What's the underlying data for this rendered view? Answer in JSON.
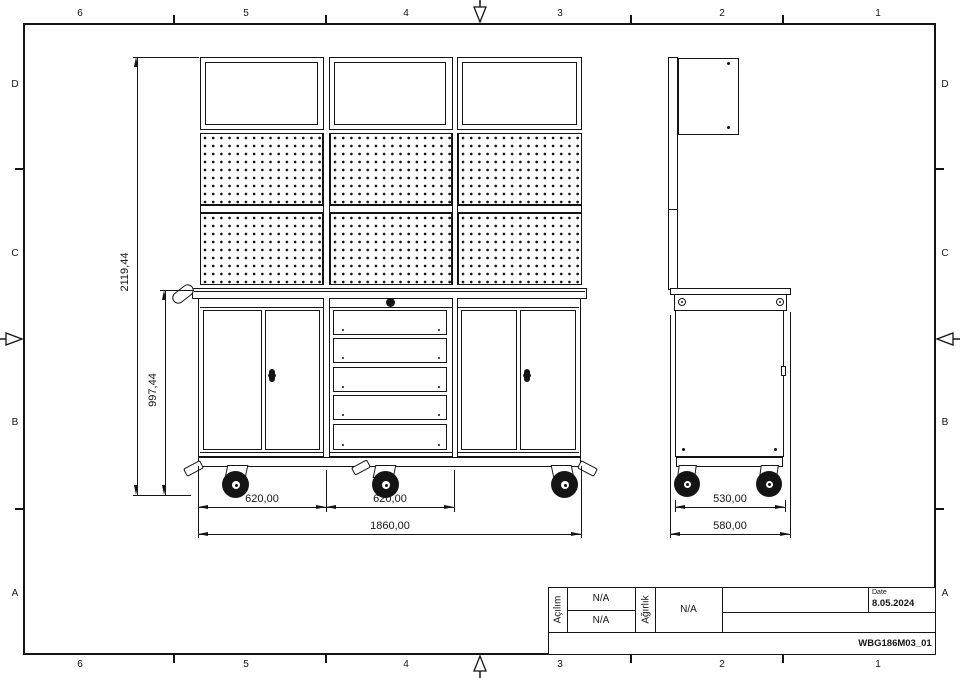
{
  "sheet": {
    "cols": [
      "6",
      "5",
      "4",
      "3",
      "2",
      "1"
    ],
    "rows": [
      "D",
      "C",
      "B",
      "A"
    ]
  },
  "dims": {
    "total_height": "2119,44",
    "base_height": "997,44",
    "module1_width": "620,00",
    "module2_width": "620,00",
    "total_width": "1860,00",
    "side_body_depth": "530,00",
    "side_total_depth": "580,00"
  },
  "title_block": {
    "acilim_label": "Açılım",
    "acilim_value_top": "N/A",
    "acilim_value_bottom": "N/A",
    "agirlik_label": "Ağırlık",
    "agirlik_value": "N/A",
    "date_label": "Date",
    "date_value": "8.05.2024",
    "drawing_code": "WBG186M03_01"
  }
}
